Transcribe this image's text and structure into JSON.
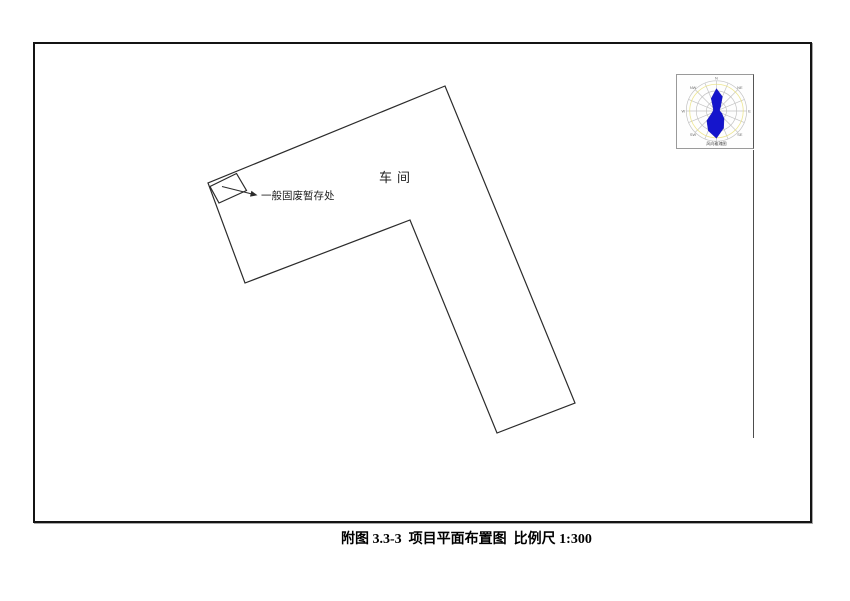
{
  "drawing": {
    "workshop_label": "车间",
    "waste_label": "一般固废暂存处",
    "line_color": "#2b2b2b",
    "frame_color": "#141414"
  },
  "geometry": {
    "building_points": "445,86 208,183 245,283 410,220 497,433 575,403",
    "square_points": "236.5,173.5 210,186.5 219,203 246.5,190.5",
    "arrow_line": {
      "x1": 222,
      "y1": 186.5,
      "x2": 252,
      "y2": 194
    },
    "arrow_head_points": "257.5,195.3 251.4,190.8 250,196.6",
    "boundary_line": {
      "x1": 753.5,
      "y1": 150,
      "x2": 753.5,
      "y2": 438
    }
  },
  "wind_rose": {
    "caption": "风向玫瑰图",
    "fill_color": "#1515cc",
    "grid_color": "#c2c2c2",
    "accent_color": "#eae27f",
    "label_color": "#6a6a6a",
    "rings": [
      10.3,
      20.7,
      31
    ],
    "spokes": 16,
    "radii": [
      23,
      16,
      6,
      3.5,
      3.5,
      6,
      11,
      19,
      28,
      22,
      14,
      5,
      3.5,
      3.5,
      5,
      14
    ],
    "direction_labels": [
      "N",
      "NE",
      "E",
      "SE",
      "S",
      "SW",
      "W",
      "NW"
    ]
  },
  "caption": {
    "text": "附图 3.3-3  项目平面布置图  比例尺 1:300"
  }
}
